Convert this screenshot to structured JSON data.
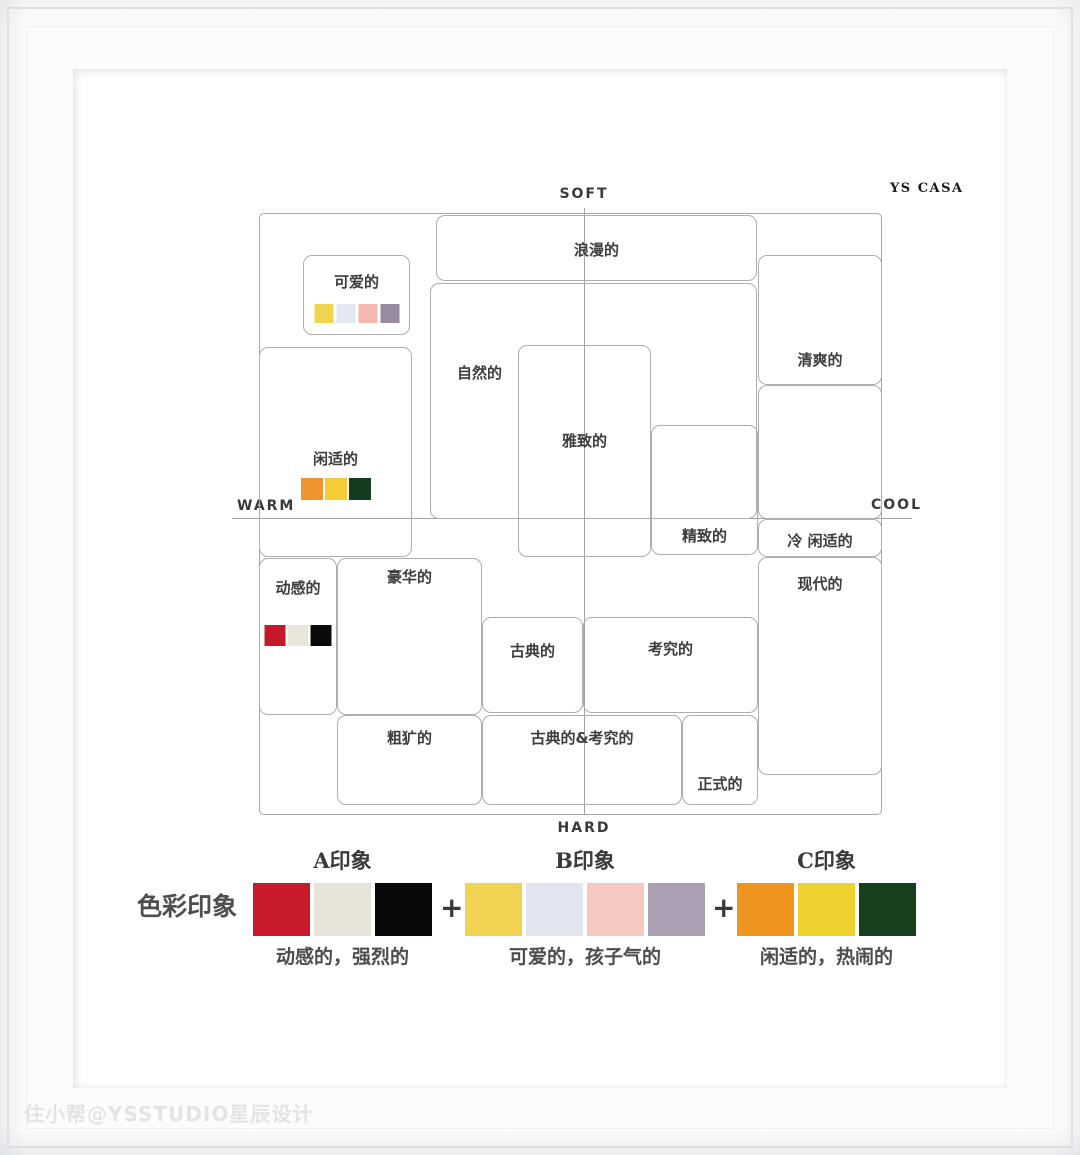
{
  "brand": "YS CASA",
  "watermark": "住小帮@YSSTUDIO星辰设计",
  "axes": {
    "soft": "SOFT",
    "hard": "HARD",
    "warm": "WARM",
    "cool": "COOL"
  },
  "map": {
    "romantic": "浪漫的",
    "cute": "可爱的",
    "cute_colors": [
      "#EFD54D",
      "#E3E8F2",
      "#F5B8B0",
      "#988AA0"
    ],
    "fresh": "清爽的",
    "natural": "自然的",
    "elegant": "雅致的",
    "exquisite": "精致的",
    "cool_leisurely": "冷 闲适的",
    "modern": "现代的",
    "leisurely": "闲适的",
    "leisurely_colors": [
      "#F0942D",
      "#F3CD35",
      "#143C1E"
    ],
    "dynamic": "动感的",
    "dynamic_colors": [
      "#C5182B",
      "#E8E6DB",
      "#0C090A"
    ],
    "luxurious": "豪华的",
    "classical": "古典的",
    "refined": "考究的",
    "rugged": "粗犷的",
    "classical_refined": "古典的&考究的",
    "formal": "正式的"
  },
  "legend": {
    "title": "色彩印象",
    "plus": "+",
    "groups": [
      {
        "name": "A印象",
        "colors": [
          "#C81A2B",
          "#E6E4D8",
          "#0B0809"
        ],
        "desc": "动感的，强烈的"
      },
      {
        "name": "B印象",
        "colors": [
          "#F1D351",
          "#E0E5F0",
          "#F6C8C2",
          "#ABA0B3"
        ],
        "desc": "可爱的，孩子气的"
      },
      {
        "name": "C印象",
        "colors": [
          "#F09420",
          "#EDD12E",
          "#16401E"
        ],
        "desc": "闲适的，热闹的"
      }
    ]
  }
}
